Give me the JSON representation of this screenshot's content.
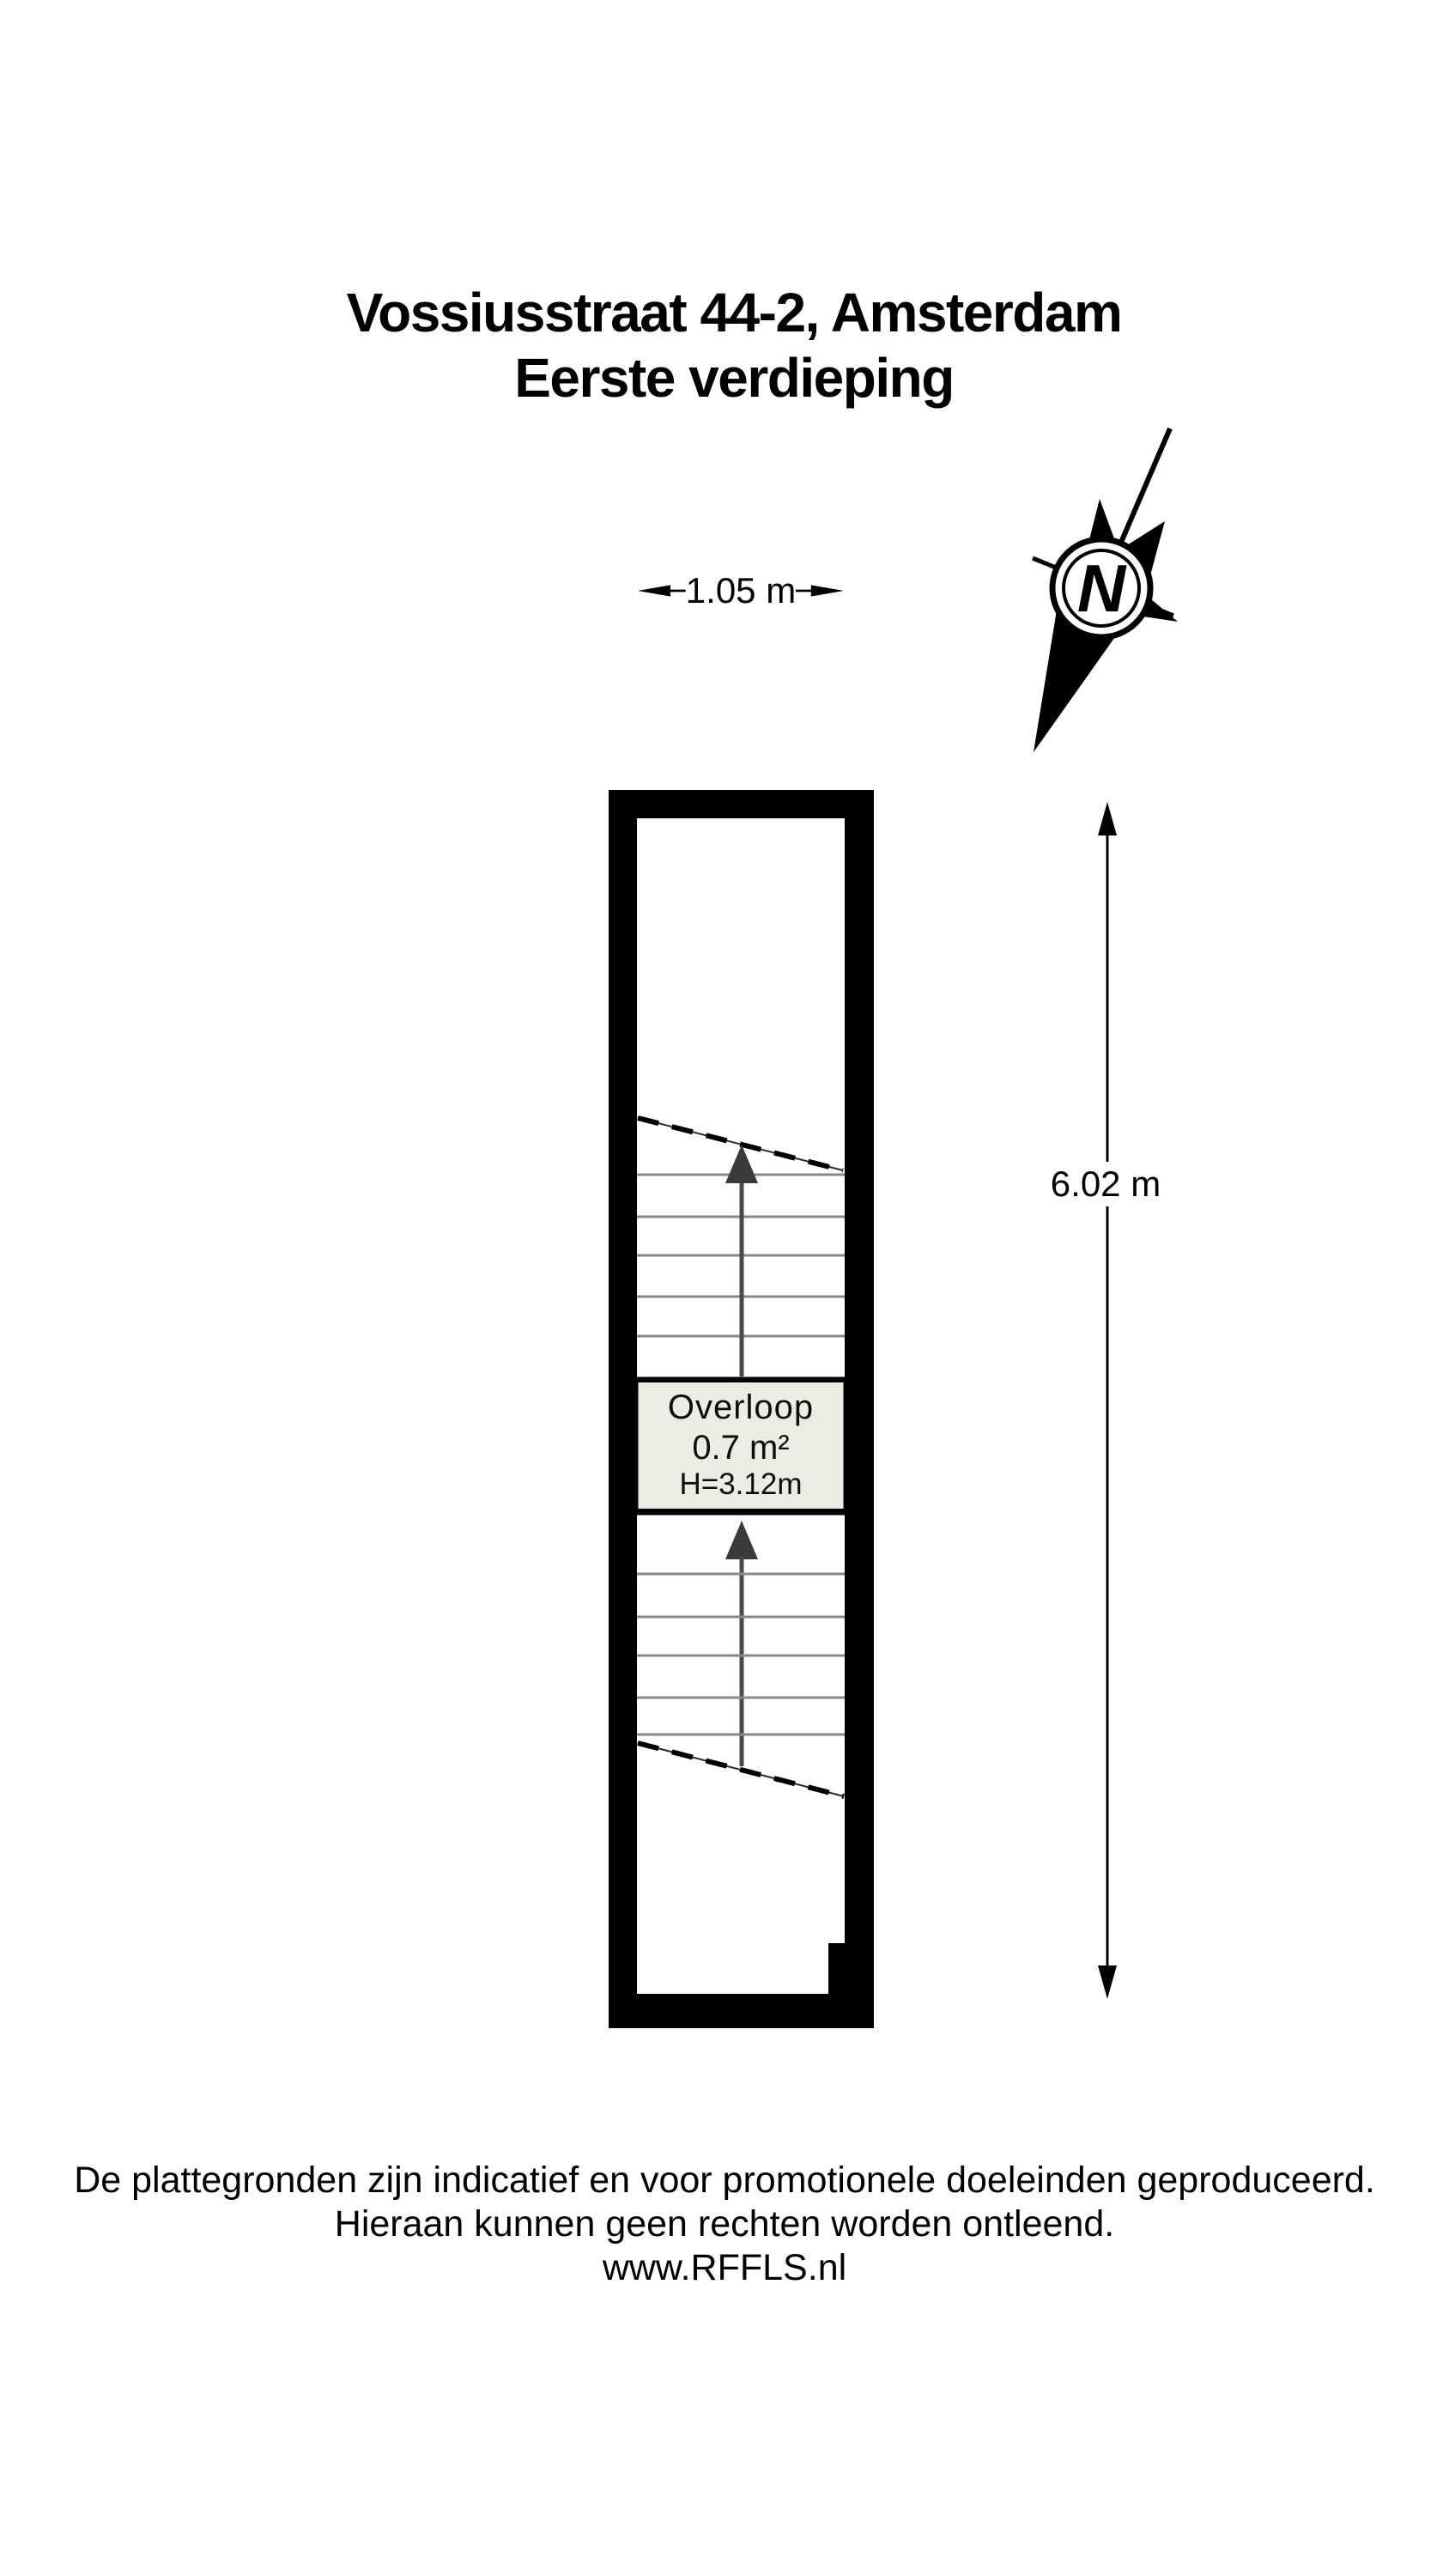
{
  "header": {
    "title": "Vossiusstraat 44-2, Amsterdam",
    "subtitle": "Eerste verdieping"
  },
  "dimensions": {
    "width_label": "1.05 m",
    "height_label": "6.02 m"
  },
  "compass": {
    "north_label": "N"
  },
  "room": {
    "name": "Overloop",
    "area": "0.7 m²",
    "ceiling_height": "H=3.12m"
  },
  "footer": {
    "line1": "De plattegronden zijn indicatief en voor promotionele doeleinden geproduceerd.",
    "line2": "Hieraan kunnen geen rechten worden ontleend.",
    "line3": "www.RFFLS.nl"
  },
  "colors": {
    "wall": "#000000",
    "floor": "#ffffff",
    "room_fill": "#ecece5",
    "tread_line": "#878787",
    "stair_arrow": "#3a3a3a",
    "dash_line": "#000000"
  }
}
